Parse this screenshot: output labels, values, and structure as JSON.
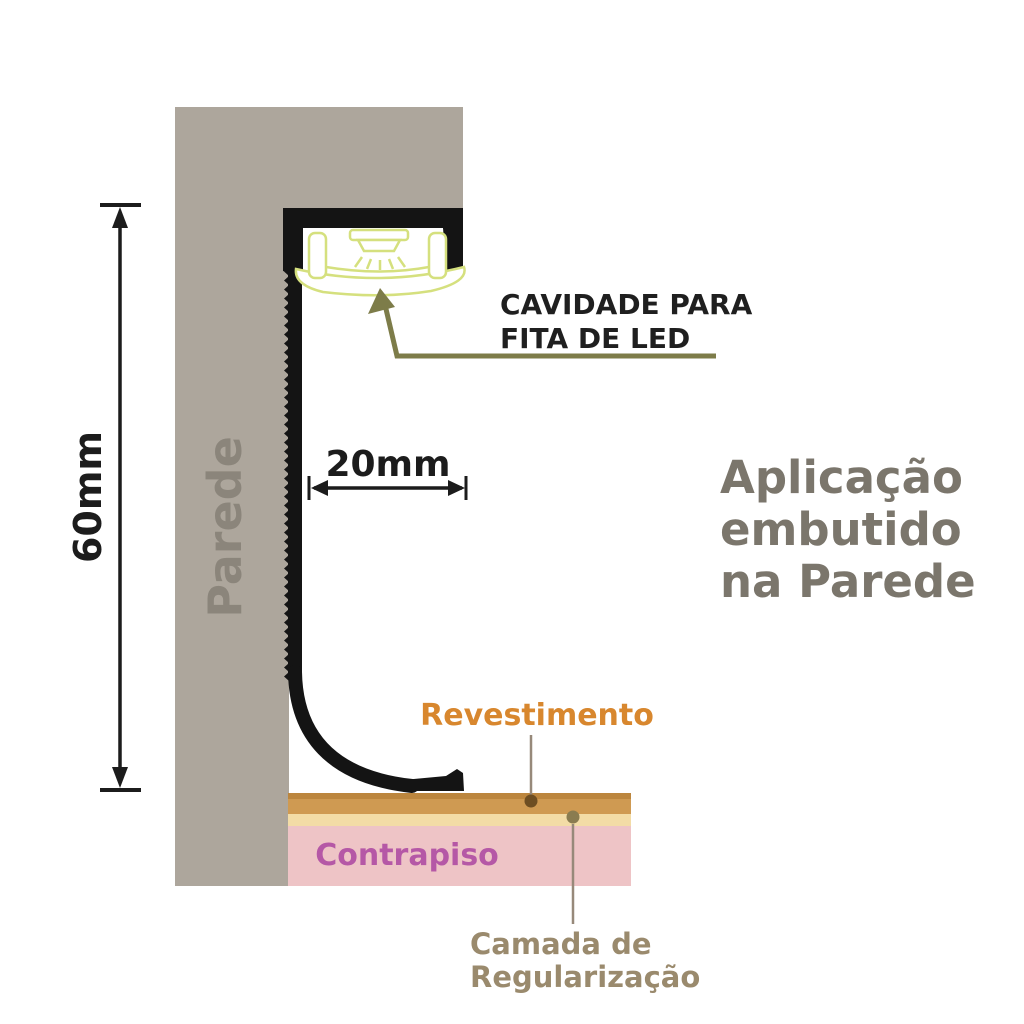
{
  "labels": {
    "wall": "Parede",
    "height_dim": "60mm",
    "width_dim": "20mm",
    "cavity_line1": "CAVIDADE PARA",
    "cavity_line2": "FITA DE LED",
    "title_line1": "Aplicação",
    "title_line2": "embutido",
    "title_line3": "na Parede",
    "revestimento": "Revestimento",
    "contrapiso": "Contrapiso",
    "regularizacao_line1": "Camada de",
    "regularizacao_line2": "Regularização"
  },
  "colors": {
    "background": "#ffffff",
    "wall": "#ada69c",
    "wall_text": "#8b857b",
    "profile": "#141414",
    "led_outline": "#d5e07e",
    "dim": "#1c1c1c",
    "cavity_text": "#1f1f1f",
    "olive": "#7d7c49",
    "title_text": "#7b766c",
    "revestimento_text": "#d8872e",
    "revestimento_band": "#cf9a52",
    "revestimento_band_dark": "#bc863e",
    "regularizacao_band": "#f3dca6",
    "contrapiso_band": "#eec4c6",
    "contrapiso_text": "#b558a6",
    "regularizacao_text": "#9a8a6d",
    "revestimento_dot": "#6e4e22",
    "regularizacao_dot": "#8a7c50",
    "callout_line": "#97897a"
  }
}
